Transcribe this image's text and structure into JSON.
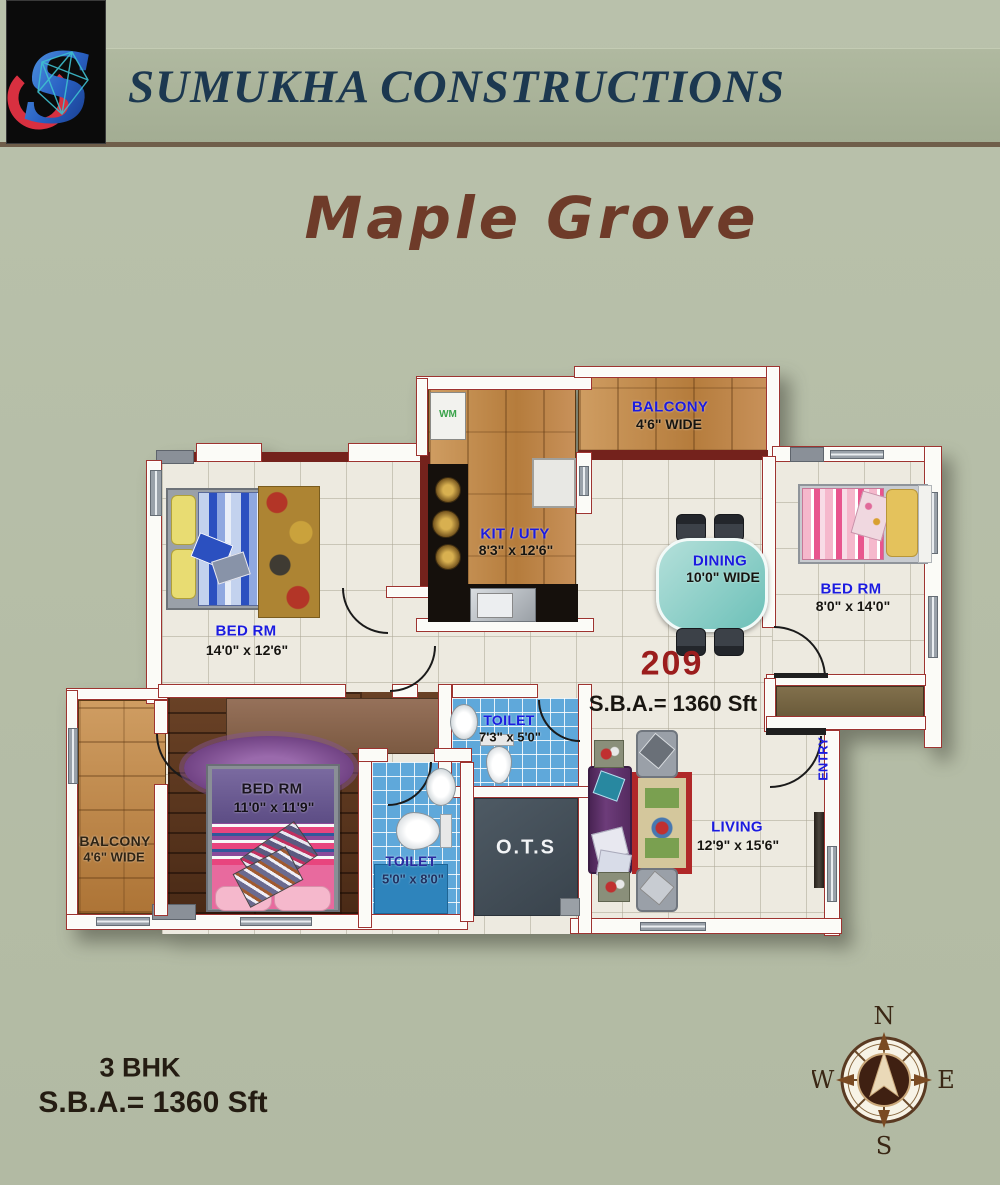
{
  "header": {
    "company": "SUMUKHA CONSTRUCTIONS",
    "logo_letter": "S"
  },
  "title": "Maple Grove",
  "plan": {
    "unit_number": "209",
    "unit_sba": "S.B.A.= 1360 Sft",
    "rooms": {
      "bed1": {
        "name": "BED RM",
        "dims": "14'0\" x 12'6\""
      },
      "kitchen": {
        "name": "KIT / UTY",
        "dims": "8'3\" x 12'6\""
      },
      "balcony_top": {
        "name": "BALCONY",
        "dims": "4'6\" WIDE"
      },
      "dining": {
        "name": "DINING",
        "dims": "10'0\" WIDE"
      },
      "bed2": {
        "name": "BED RM",
        "dims": "8'0\" x 14'0\""
      },
      "bed3": {
        "name": "BED RM",
        "dims": "11'0\" x 11'9\""
      },
      "balcony_left": {
        "name": "BALCONY",
        "dims": "4'6\" WIDE"
      },
      "toilet_top": {
        "name": "TOILET",
        "dims": "7'3\" x 5'0\""
      },
      "toilet_left": {
        "name": "TOILET",
        "dims": "5'0\" x 8'0\""
      },
      "ots": {
        "name": "O.T.S"
      },
      "living": {
        "name": "LIVING",
        "dims": "12'9\" x 15'6\""
      },
      "entry": {
        "name": "ENTRY"
      },
      "wm": {
        "name": "WM"
      }
    }
  },
  "footer": {
    "bhk": "3 BHK",
    "sba": "S.B.A.= 1360 Sft"
  },
  "compass": {
    "north": "N",
    "east": "E",
    "south": "S",
    "west": "W"
  },
  "colors": {
    "background": "#b7bfa9",
    "band": "#a9b199",
    "brand_text": "#1c3850",
    "title_brown": "#6e3b29",
    "label_blue": "#1b1be0",
    "wall_outline": "#9e3430",
    "unit_red": "#9b1d1d",
    "dining_teal": "#7cc4be",
    "toilet_blue": "#5fa8da",
    "wood": "#c08a4e",
    "dark_wood": "#57331f"
  }
}
